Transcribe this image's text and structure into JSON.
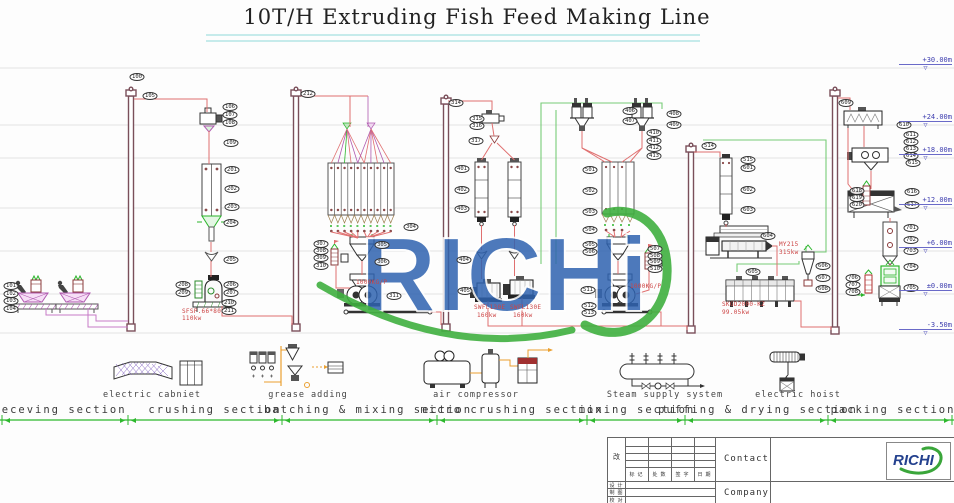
{
  "title": "10T/H Extruding Fish Feed Making Line",
  "sections": [
    {
      "label": "receving section",
      "x": 60
    },
    {
      "label": "crushing section",
      "x": 215
    },
    {
      "label": "batching & mixing section",
      "x": 368
    },
    {
      "label": "micro crushing section",
      "x": 512
    },
    {
      "label": "mixing section",
      "x": 637
    },
    {
      "label": "puffing & drying section",
      "x": 758
    },
    {
      "label": "packing section",
      "x": 893
    }
  ],
  "equipment_labels": [
    {
      "label": "electric cabniet",
      "x": 152
    },
    {
      "label": "grease adding",
      "x": 308
    },
    {
      "label": "air compressor",
      "x": 476
    },
    {
      "label": "Steam supply system",
      "x": 665
    },
    {
      "label": "electric hoist",
      "x": 798
    }
  ],
  "elevations": [
    {
      "label": "+30.00m",
      "y": 56
    },
    {
      "label": "+24.00m",
      "y": 113
    },
    {
      "label": "+18.00m",
      "y": 146
    },
    {
      "label": "+12.00m",
      "y": 196
    },
    {
      "label": "+6.00m",
      "y": 239
    },
    {
      "label": "±0.00m",
      "y": 282
    },
    {
      "label": "-3.50m",
      "y": 321
    }
  ],
  "tags": [
    {
      "id": "101",
      "x": 11,
      "y": 286
    },
    {
      "id": "102",
      "x": 11,
      "y": 294
    },
    {
      "id": "103",
      "x": 11,
      "y": 301
    },
    {
      "id": "104",
      "x": 11,
      "y": 309
    },
    {
      "id": "100",
      "x": 137,
      "y": 77
    },
    {
      "id": "105",
      "x": 150,
      "y": 96
    },
    {
      "id": "106",
      "x": 230,
      "y": 107
    },
    {
      "id": "107",
      "x": 230,
      "y": 115
    },
    {
      "id": "108",
      "x": 230,
      "y": 123
    },
    {
      "id": "109",
      "x": 231,
      "y": 143
    },
    {
      "id": "201",
      "x": 232,
      "y": 170
    },
    {
      "id": "202",
      "x": 232,
      "y": 189
    },
    {
      "id": "203",
      "x": 232,
      "y": 207
    },
    {
      "id": "204",
      "x": 231,
      "y": 223
    },
    {
      "id": "205",
      "x": 231,
      "y": 260
    },
    {
      "id": "206",
      "x": 231,
      "y": 285
    },
    {
      "id": "207",
      "x": 231,
      "y": 293
    },
    {
      "id": "208",
      "x": 183,
      "y": 285
    },
    {
      "id": "209",
      "x": 183,
      "y": 293
    },
    {
      "id": "210",
      "x": 229,
      "y": 303
    },
    {
      "id": "211",
      "x": 229,
      "y": 311
    },
    {
      "id": "212",
      "x": 308,
      "y": 94
    },
    {
      "id": "304",
      "x": 411,
      "y": 227
    },
    {
      "id": "305",
      "x": 382,
      "y": 245
    },
    {
      "id": "306",
      "x": 382,
      "y": 262
    },
    {
      "id": "307",
      "x": 321,
      "y": 244
    },
    {
      "id": "308",
      "x": 321,
      "y": 251
    },
    {
      "id": "309",
      "x": 321,
      "y": 258
    },
    {
      "id": "310",
      "x": 321,
      "y": 266
    },
    {
      "id": "311",
      "x": 394,
      "y": 296
    },
    {
      "id": "314",
      "x": 456,
      "y": 103
    },
    {
      "id": "315",
      "x": 477,
      "y": 119
    },
    {
      "id": "316",
      "x": 477,
      "y": 126
    },
    {
      "id": "317",
      "x": 476,
      "y": 141
    },
    {
      "id": "401",
      "x": 462,
      "y": 169
    },
    {
      "id": "402",
      "x": 462,
      "y": 190
    },
    {
      "id": "403",
      "x": 462,
      "y": 209
    },
    {
      "id": "404",
      "x": 464,
      "y": 260
    },
    {
      "id": "405",
      "x": 465,
      "y": 291
    },
    {
      "id": "406",
      "x": 630,
      "y": 111
    },
    {
      "id": "407",
      "x": 630,
      "y": 121
    },
    {
      "id": "408",
      "x": 674,
      "y": 114
    },
    {
      "id": "409",
      "x": 674,
      "y": 125
    },
    {
      "id": "410",
      "x": 654,
      "y": 133
    },
    {
      "id": "411",
      "x": 654,
      "y": 141
    },
    {
      "id": "412",
      "x": 654,
      "y": 148
    },
    {
      "id": "413",
      "x": 654,
      "y": 156
    },
    {
      "id": "501",
      "x": 590,
      "y": 170
    },
    {
      "id": "502",
      "x": 590,
      "y": 191
    },
    {
      "id": "503",
      "x": 590,
      "y": 212
    },
    {
      "id": "504",
      "x": 590,
      "y": 230
    },
    {
      "id": "505",
      "x": 590,
      "y": 245
    },
    {
      "id": "506",
      "x": 590,
      "y": 252
    },
    {
      "id": "507",
      "x": 655,
      "y": 249
    },
    {
      "id": "508",
      "x": 655,
      "y": 256
    },
    {
      "id": "509",
      "x": 655,
      "y": 262
    },
    {
      "id": "510",
      "x": 655,
      "y": 269
    },
    {
      "id": "511",
      "x": 588,
      "y": 290
    },
    {
      "id": "512",
      "x": 589,
      "y": 306
    },
    {
      "id": "513",
      "x": 589,
      "y": 313
    },
    {
      "id": "514",
      "x": 709,
      "y": 146
    },
    {
      "id": "515",
      "x": 748,
      "y": 160
    },
    {
      "id": "601",
      "x": 748,
      "y": 168
    },
    {
      "id": "602",
      "x": 748,
      "y": 190
    },
    {
      "id": "603",
      "x": 748,
      "y": 210
    },
    {
      "id": "604",
      "x": 768,
      "y": 236
    },
    {
      "id": "605",
      "x": 753,
      "y": 272
    },
    {
      "id": "606",
      "x": 823,
      "y": 266
    },
    {
      "id": "607",
      "x": 823,
      "y": 278
    },
    {
      "id": "608",
      "x": 823,
      "y": 289
    },
    {
      "id": "609",
      "x": 846,
      "y": 103
    },
    {
      "id": "610",
      "x": 904,
      "y": 125
    },
    {
      "id": "611",
      "x": 911,
      "y": 135
    },
    {
      "id": "612",
      "x": 911,
      "y": 142
    },
    {
      "id": "613",
      "x": 911,
      "y": 149
    },
    {
      "id": "614",
      "x": 911,
      "y": 156
    },
    {
      "id": "615",
      "x": 913,
      "y": 163
    },
    {
      "id": "616",
      "x": 912,
      "y": 192
    },
    {
      "id": "617",
      "x": 912,
      "y": 205
    },
    {
      "id": "618",
      "x": 857,
      "y": 191
    },
    {
      "id": "619",
      "x": 857,
      "y": 198
    },
    {
      "id": "620",
      "x": 857,
      "y": 205
    },
    {
      "id": "701",
      "x": 911,
      "y": 228
    },
    {
      "id": "702",
      "x": 911,
      "y": 240
    },
    {
      "id": "703",
      "x": 911,
      "y": 251
    },
    {
      "id": "704",
      "x": 911,
      "y": 267
    },
    {
      "id": "705",
      "x": 911,
      "y": 288
    },
    {
      "id": "706",
      "x": 853,
      "y": 278
    },
    {
      "id": "707",
      "x": 853,
      "y": 285
    },
    {
      "id": "708",
      "x": 853,
      "y": 292
    }
  ],
  "notes": [
    {
      "text": "SFSP.66*80",
      "x": 182,
      "y": 308
    },
    {
      "text": "110kw",
      "x": 182,
      "y": 315
    },
    {
      "text": "1000KG/P",
      "x": 356,
      "y": 279
    },
    {
      "text": "SWFL130E",
      "x": 474,
      "y": 304
    },
    {
      "text": "160kw",
      "x": 477,
      "y": 312
    },
    {
      "text": "SWFL130E",
      "x": 510,
      "y": 304
    },
    {
      "text": "160kw",
      "x": 513,
      "y": 312
    },
    {
      "text": "1000KG/P",
      "x": 630,
      "y": 283
    },
    {
      "text": "MY215",
      "x": 779,
      "y": 241
    },
    {
      "text": "315kw",
      "x": 779,
      "y": 249
    },
    {
      "text": "SKGD2000-KZ",
      "x": 722,
      "y": 301
    },
    {
      "text": "99.05kw",
      "x": 722,
      "y": 309
    }
  ],
  "watermark": {
    "text": "RICHi"
  },
  "titleblock": {
    "change_label": "改",
    "col_headers": [
      "标 记",
      "处 数",
      "签 字",
      "日 期"
    ],
    "row_labels": [
      "设 计",
      "制 图",
      "校 对"
    ],
    "contact_label": "Contact",
    "company_label": "Company",
    "logo_text": "RICHI"
  },
  "colors": {
    "accent_green": "#2db82d",
    "piping_red": "#e07070",
    "elevator": "#7a4f5a",
    "cyan_rule": "#8fd9d9",
    "elevation_blue": "#4040b0",
    "watermark_blue": "#2f63b0",
    "watermark_green": "#3faf3f"
  }
}
